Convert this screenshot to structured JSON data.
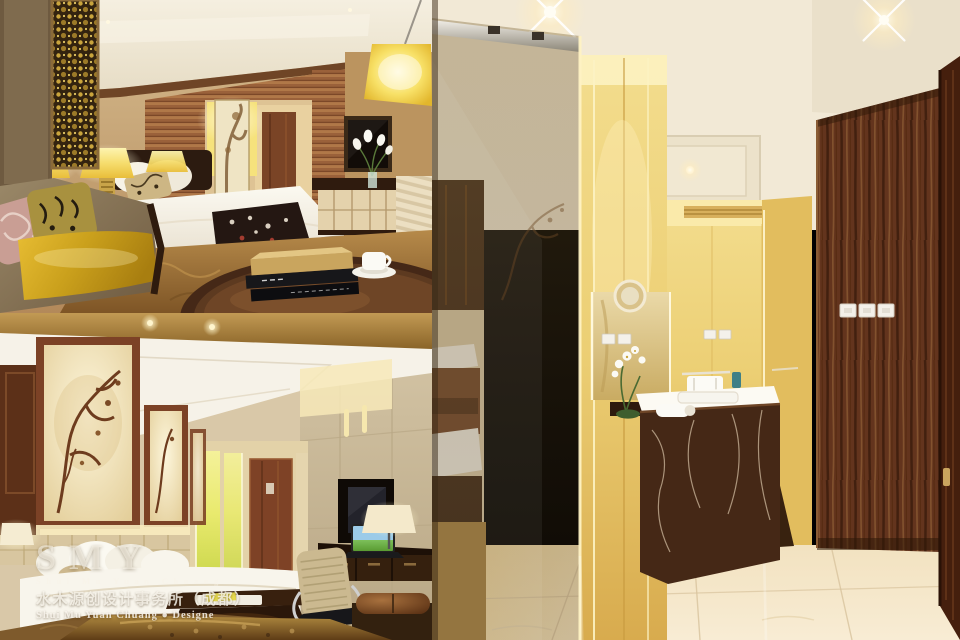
{
  "watermark": {
    "initials": "SMY",
    "name_spaced": "Shui Mu Yuan Chuang",
    "studio_cn": "水木源创设计事务所（成都）",
    "studio_en": "Shui Mu Yuan Chuang ● Designe"
  },
  "panels": {
    "top_left": {
      "label": "hotel-bedroom-lounge-photo"
    },
    "bottom_left": {
      "label": "hotel-bedroom-desk-photo"
    },
    "right": {
      "label": "hotel-bathroom-corridor-photo"
    }
  },
  "palette": {
    "lamp_gold": "#f6dd6e",
    "wall_tan": "#c4a476",
    "ceiling_cream": "#f2ead8",
    "carpet_gold": "#a87c3e",
    "walnut": "#62341d",
    "marble_brown": "#452816"
  }
}
